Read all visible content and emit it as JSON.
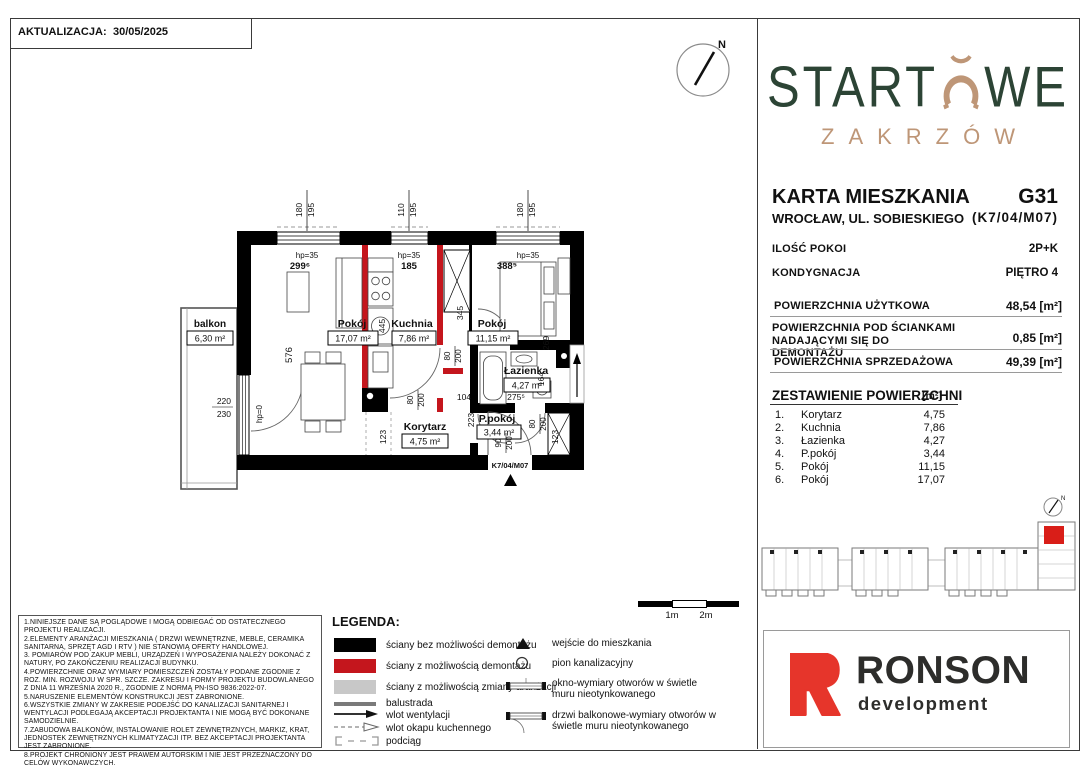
{
  "header": {
    "update_label": "AKTUALIZACJA:",
    "update_date": "30/05/2025"
  },
  "compass": {
    "north": "N"
  },
  "brand": {
    "logo_part1": "START",
    "logo_part2": "WE",
    "logo_subtitle": "ZAKRZÓW",
    "green": "#2C4435",
    "tan": "#BE9677"
  },
  "card": {
    "title": "KARTA MIESZKANIA",
    "unit_code": "G31",
    "address": "WROCŁAW, UL. SOBIESKIEGO",
    "unit_ref": "(K7/04/M07)",
    "rooms_label": "ILOŚĆ POKOI",
    "rooms_value": "2P+K",
    "floor_label": "KONDYGNACJA",
    "floor_value": "PIĘTRO 4"
  },
  "areas": {
    "usable_label": "POWIERZCHNIA UŻYTKOWA",
    "usable_value": "48,54 [m²]",
    "partition_label": "POWIERZCHNIA POD ŚCIANKAMI NADAJĄCYMI SIĘ DO DEMONTAŻU",
    "partition_value": "0,85 [m²]",
    "sales_label": "POWIERZCHNIA SPRZEDAŻOWA",
    "sales_value": "49,39 [m²]"
  },
  "room_table": {
    "title": "ZESTAWIENIE POWIERZCHNI",
    "unit": "[m²]",
    "rows": [
      {
        "no": "1.",
        "name": "Korytarz",
        "area": "4,75"
      },
      {
        "no": "2.",
        "name": "Kuchnia",
        "area": "7,86"
      },
      {
        "no": "3.",
        "name": "Łazienka",
        "area": "4,27"
      },
      {
        "no": "4.",
        "name": "P.pokój",
        "area": "3,44"
      },
      {
        "no": "5.",
        "name": "Pokój",
        "area": "11,15"
      },
      {
        "no": "6.",
        "name": "Pokój",
        "area": "17,07"
      }
    ]
  },
  "plan": {
    "rooms": [
      {
        "name": "balkon",
        "area": "6,30 m²"
      },
      {
        "name": "Pokój",
        "area": "17,07 m²"
      },
      {
        "name": "Kuchnia",
        "area": "7,86 m²"
      },
      {
        "name": "Pokój",
        "area": "11,15 m²"
      },
      {
        "name": "Łazienka",
        "area": "4,27 m²"
      },
      {
        "name": "P.pokój",
        "area": "3,44 m²"
      },
      {
        "name": "Korytarz",
        "area": "4,75 m²"
      }
    ],
    "entrance_code": "K7/04/M07",
    "wall_red": "#C4161D",
    "dims": {
      "win1_w": "180",
      "win1_h": "195",
      "win2_w": "110",
      "win2_h": "195",
      "win3_w": "180",
      "win3_h": "195",
      "hp35": "hp=35",
      "hp0": "hp=0",
      "room1_w": "299⁶",
      "kitchen_w": "185",
      "room2_w": "388⁵",
      "room1_h": "576",
      "kitchen_h": "445",
      "hall_h": "345",
      "room2_h": "269",
      "balc_w": "220",
      "balc_h": "230",
      "door80": "80",
      "door90": "90",
      "door200": "200",
      "d104": "104",
      "d223": "223",
      "d123": "123",
      "d164": "164",
      "d275": "275⁵"
    }
  },
  "legend": {
    "title": "LEGENDA:",
    "walls": [
      {
        "color": "#000000",
        "label": "ściany bez możliwości demontażu"
      },
      {
        "color": "#C4161D",
        "label": "ściany z możliwością demontażu"
      },
      {
        "color": "#C8C8C8",
        "label": "ściany z możliwością zmiany aranżacji"
      }
    ],
    "lines": [
      {
        "icon": "balustrade-line",
        "label": "balustrada"
      },
      {
        "icon": "vent-arrow",
        "label": "wlot wentylacji"
      },
      {
        "icon": "hood-arrow",
        "label": "wlot okapu kuchennego"
      },
      {
        "icon": "beam-dashed",
        "label": "podciąg"
      }
    ],
    "symbols": [
      {
        "icon": "entrance-triangle",
        "label": "wejście do mieszkania"
      },
      {
        "icon": "sewage-stack-circle",
        "label": "pion kanalizacyjny"
      },
      {
        "icon": "window-symbol",
        "label": "okno-wymiary otworów w świetle muru nieotynkowanego"
      },
      {
        "icon": "balcony-door-symbol",
        "label": "drzwi balkonowe-wymiary otworów w świetle muru nieotynkowanego"
      }
    ]
  },
  "scalebar": {
    "m1": "1m",
    "m2": "2m"
  },
  "disclaimer": {
    "lines": [
      "1.NINIEJSZE DANE SĄ POGLĄDOWE I MOGĄ ODBIEGAĆ OD OSTATECZNEGO PROJEKTU REALIZACJI.",
      "2.ELEMENTY ARANŻACJI MIESZKANIA ( DRZWI WEWNĘTRZNE, MEBLE, CERAMIKA SANITARNA, SPRZĘT AGD I RTV ) NIE STANOWIĄ OFERTY HANDLOWEJ.",
      "3. POMIARÓW POD ZAKUP MEBLI, URZĄDZEŃ I WYPOSAŻENIA NALEŻY DOKONAĆ Z NATURY, PO ZAKOŃCZENIU REALIZACJI BUDYNKU.",
      "4.POWIERZCHNIE ORAZ WYMIARY POMIESZCZEŃ ZOSTAŁY PODANE ZGODNIE Z ROZ. MIN. ROZWOJU W SPR. SZCZE. ZAKRESU I FORMY PROJEKTU BUDOWLANEGO Z DNIA 11 WRZEŚNIA 2020 R., ZGODNIE Z NORMĄ PN-ISO 9836:2022-07.",
      "5.NARUSZENIE ELEMENTÓW KONSTRUKCJI JEST ZABRONIONE.",
      "6.WSZYSTKIE ZMIANY W ZAKRESIE PODEJŚĆ DO KANALIZACJI SANITARNEJ I WENTYLACJI PODLEGAJĄ AKCEPTACJI PROJEKTANTA I NIE MOGĄ BYĆ DOKONANE SAMODZIELNIE.",
      "7.ZABUDOWA BALKONÓW, INSTALOWANIE ROLET ZEWNĘTRZNYCH, MARKIZ, KRAT, JEDNOSTEK ZEWNĘTRZNYCH KLIMATYZACJI ITP. BEZ AKCEPTACJI PROJEKTANTA JEST ZABRONIONE.",
      "8.PROJEKT CHRONIONY JEST PRAWEM AUTORSKIM I NIE JEST PRZEZNACZONY DO CELÓW WYKONAWCZYCH."
    ]
  },
  "developer": {
    "name": "RONSON",
    "subtitle": "development",
    "red": "#E6352B",
    "dark": "#2D2D2B"
  },
  "site_plan": {
    "north": "N",
    "highlight": "#D91E18"
  }
}
